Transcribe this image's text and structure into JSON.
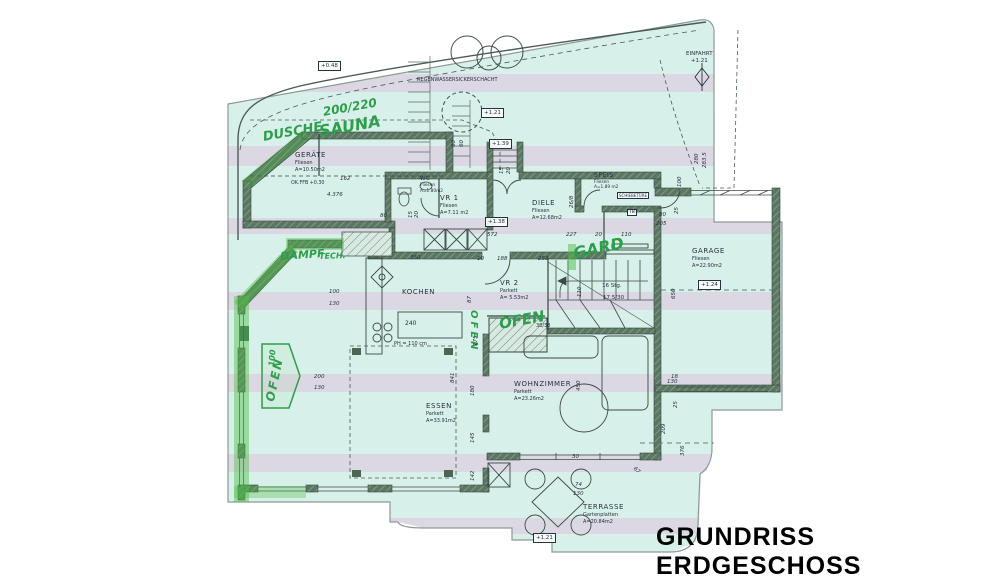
{
  "title": "GRUNDRISS ERDGESCHOSS",
  "colors": {
    "paper": "#d8f0ea",
    "stripe": "#e0c0db",
    "wall": "#5b7663",
    "marker": "#3fae4e",
    "handwriting": "#2f9e4c",
    "ink": "#26323e",
    "title": "#000000"
  },
  "rooms": {
    "geraete": {
      "name": "GERÄTE",
      "finish": "Fliesen",
      "area": "A=10.50m2"
    },
    "wc": {
      "name": "WC",
      "finish": "Fliesen",
      "area": "A=1.80m2"
    },
    "vr1": {
      "name": "VR 1",
      "finish": "Fliesen",
      "area": "A=7.11 m2"
    },
    "diele": {
      "name": "DIELE",
      "finish": "Fliesen",
      "area": "A=12.68m2"
    },
    "speis": {
      "name": "SPEIS",
      "finish": "Fliesen",
      "area": "A=1.89 m2"
    },
    "garage": {
      "name": "GARAGE",
      "finish": "Fliesen",
      "area": "A=22.90m2"
    },
    "kochen": {
      "name": "KOCHEN"
    },
    "vr2": {
      "name": "VR 2",
      "finish": "Parkett",
      "area": "A= 5.53m2"
    },
    "wohnzimmer": {
      "name": "WOHNZIMMER",
      "finish": "Parkett",
      "area": "A=23.26m2"
    },
    "essen": {
      "name": "ESSEN",
      "finish": "Parkett",
      "area": "A=33.91m2"
    },
    "terrasse": {
      "name": "TERRASSE",
      "finish": "Gartenplatten",
      "area": "A=20.84m2"
    }
  },
  "levels": {
    "l048": "+0.48",
    "l121_entry": "+1.21",
    "l139": "+1.39",
    "l138": "+1.38",
    "l124": "+1.24",
    "l121_terrasse": "+1.21"
  },
  "site": {
    "regenwasser": "REGENWASSERSICKERSCHACHT",
    "einfahrt": "EINFAHRT",
    "einfahrt_level": "+1.21",
    "ok_ffb": "OK.FFB +0.30",
    "schiebetuere": "SCHIEBETÜRE",
    "tuer": "TB"
  },
  "stairs": {
    "count": "16 Stg.",
    "step": "17.5/30",
    "single_step": "38/38"
  },
  "kitchen": {
    "island": "240",
    "note": "PH = 110 cm"
  },
  "green_notes": {
    "dusche": "DUSCHE",
    "sauna": "SAUNA",
    "sauna_dim": "200/220",
    "dampf": "DAMPF",
    "tech": "TECH.",
    "gard": "GARD",
    "ofen_livingroom": "OFEN",
    "ofen_wall": "OFEN",
    "ofen_bay": "OFEN",
    "ofen_bay_dim": "100"
  },
  "dims": [
    "162",
    "4.376",
    "80",
    "350",
    "572",
    "227",
    "20",
    "110",
    "10",
    "188",
    "253",
    "200",
    "130",
    "100",
    "130",
    "80",
    "205",
    "130",
    "30",
    "18",
    "74",
    "130",
    "841",
    "180",
    "145",
    "142",
    "175",
    "450",
    "650",
    "25",
    "100",
    "25",
    "280",
    "283.5",
    "209",
    "376",
    "15",
    "20",
    "15",
    "20",
    "60",
    "60",
    "26/8",
    "87",
    "110",
    "67"
  ]
}
